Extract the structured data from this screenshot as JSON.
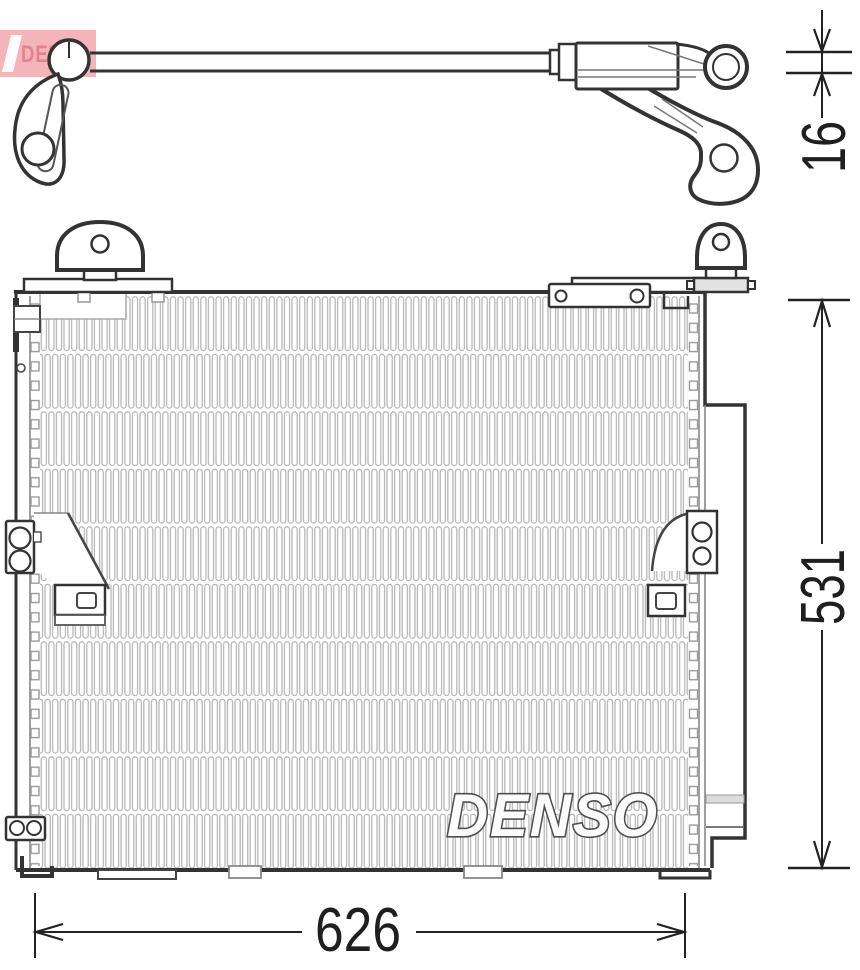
{
  "drawing": {
    "type": "technical-part-diagram",
    "part": "condenser-with-pipe",
    "logo": {
      "text": "DENSO",
      "bg_color": "#f3b4ba",
      "text_color": "#e4838f"
    },
    "watermark": {
      "text": "DENSO"
    },
    "dimensions": {
      "pipe_height": {
        "value": "16",
        "orientation": "vertical"
      },
      "condenser_height": {
        "value": "531",
        "orientation": "vertical"
      },
      "condenser_width": {
        "value": "626",
        "orientation": "horizontal"
      }
    },
    "colors": {
      "outline": "#333333",
      "secondary": "#888888",
      "fin": "#b8b8b8",
      "logo_red": "#f3b4ba"
    }
  }
}
